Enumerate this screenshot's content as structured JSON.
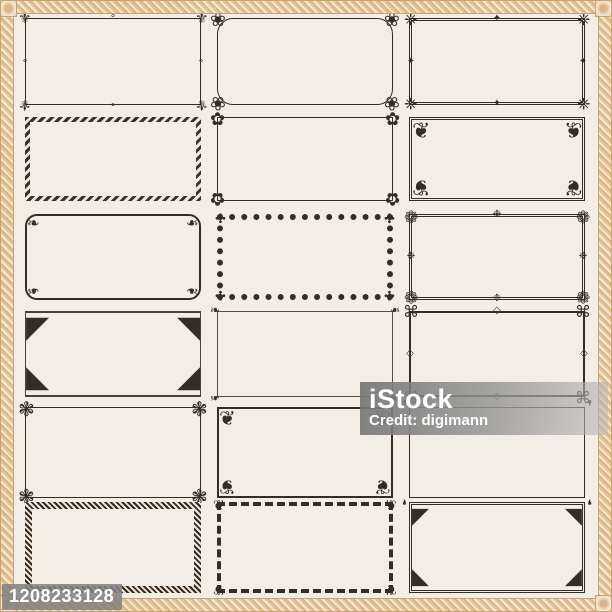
{
  "watermark": {
    "brand": "iStock",
    "credit": "Credit: digimann"
  },
  "badge": {
    "photo_id": "1208233128"
  },
  "palette": {
    "background": "#f2eee6",
    "frame_ink": "#352c24",
    "border_gold": "#d9b587",
    "border_gold_light": "#f4ead7",
    "watermark_gray": "#8f8f8f",
    "watermark_text": "#ffffff"
  },
  "frames": [
    {
      "name": "frame-fleur-de-lis-corners",
      "style": "b-solid1",
      "corner_icon": "fleur-de-lis-icon",
      "glyph": "⚜",
      "size": 15,
      "edge_glyph": "∘",
      "edge_icon": "scroll-accent-icon"
    },
    {
      "name": "frame-rounded-rosette-corners",
      "style": "b-solid1 rounded-lg",
      "corner_icon": "rosette-cluster-icon",
      "glyph": "❀",
      "size": 19
    },
    {
      "name": "frame-double-line-cross-corners",
      "style": "b-double3",
      "corner_icon": "cross-floret-icon",
      "glyph": "❈",
      "size": 16,
      "edge_glyph": "✦",
      "edge_icon": "diamond-accent-icon"
    },
    {
      "name": "frame-ornament-band",
      "style": "b-motif",
      "corner_icon": "",
      "glyph": "",
      "size": 0
    },
    {
      "name": "frame-rose-corners",
      "style": "b-solid1",
      "corner_icon": "rose-icon",
      "glyph": "✿",
      "size": 18
    },
    {
      "name": "frame-acanthus-fan-corners",
      "style": "b-double3",
      "corner_icon": "acanthus-fan-icon",
      "glyph": "❦",
      "size": 22,
      "inset": true
    },
    {
      "name": "frame-rounded-scroll-corners",
      "style": "b-solid2 rounded-md",
      "corner_icon": "scroll-icon",
      "glyph": "❧",
      "size": 15,
      "inset": true
    },
    {
      "name": "frame-beaded-band",
      "style": "b-dotted6",
      "corner_icon": "floret-icon",
      "glyph": "✣",
      "size": 13
    },
    {
      "name": "frame-floral-sprig-corners",
      "style": "b-double3",
      "corner_icon": "sprig-icon",
      "glyph": "❁",
      "size": 17,
      "edge_glyph": "❉",
      "edge_icon": "floret-accent-icon"
    },
    {
      "name": "frame-damask-triangle-corners",
      "style": "b-mixed",
      "corner_icon": "damask-triangle-icon",
      "glyph": "◤",
      "size": 30,
      "inset": true
    },
    {
      "name": "frame-delicate-scroll-corners",
      "style": "b-solid1 b-light",
      "corner_icon": "small-scroll-icon",
      "glyph": "❧",
      "size": 12
    },
    {
      "name": "frame-greek-key-corners",
      "style": "b-solid2",
      "corner_icon": "greek-key-icon",
      "glyph": "⌘",
      "size": 16,
      "edge_glyph": "◇",
      "edge_icon": "diamond-accent-icon"
    },
    {
      "name": "frame-crossed-frond-corners",
      "style": "b-solid1",
      "corner_icon": "crossed-frond-icon",
      "glyph": "❃",
      "size": 20
    },
    {
      "name": "frame-plume-scroll-corners",
      "style": "b-solid2",
      "corner_icon": "plume-icon",
      "glyph": "❦",
      "size": 20,
      "inset": true
    },
    {
      "name": "frame-chamfered-scroll-corners",
      "style": "b-solid1",
      "corner_icon": "scroll-dot-icon",
      "glyph": "❜",
      "size": 16
    },
    {
      "name": "frame-guilloche-band",
      "style": "b-guilloche",
      "corner_icon": "",
      "glyph": "",
      "size": 0
    },
    {
      "name": "frame-chain-band-scroll-corners",
      "style": "b-dashed4",
      "corner_icon": "scroll-icon",
      "glyph": "❦",
      "size": 14
    },
    {
      "name": "frame-octagon-damask-corners",
      "style": "b-double3",
      "corner_icon": "damask-triangle-icon",
      "glyph": "◤",
      "size": 22,
      "inset": true
    }
  ]
}
